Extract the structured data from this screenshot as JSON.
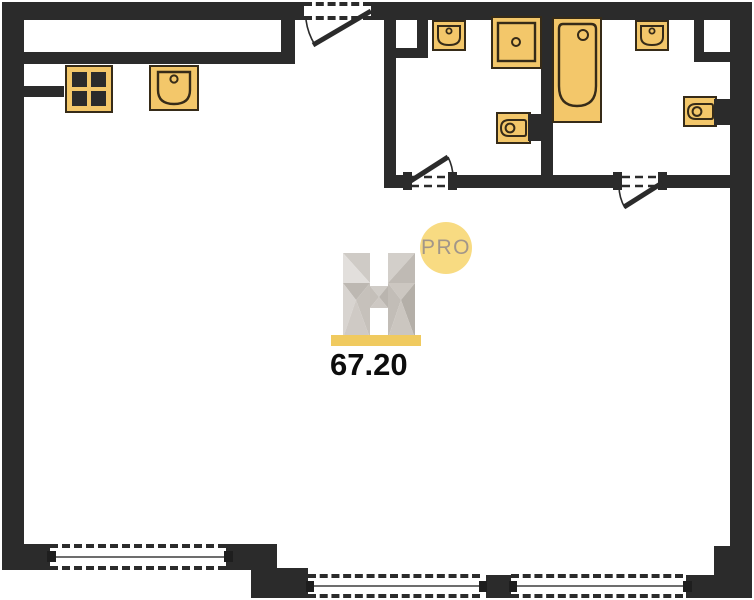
{
  "meta": {
    "kind": "apartment-floor-plan",
    "width_px": 754,
    "height_px": 600
  },
  "branding": {
    "logo_letter": "H",
    "badge": "PRO"
  },
  "area_label": {
    "value": "67.20"
  },
  "colors": {
    "wall": "#2b2b2b",
    "fixture_fill": "#F3C76A",
    "fixture_stroke": "#362B18",
    "logo_bar_yellow": "#F0CA5F",
    "badge_fill": "#F8DB82",
    "badge_text": "#A29689",
    "window_center_line": "#6d6d6d",
    "area_text": "#0d0d0d",
    "logo_gray_light": "#E2DFDC",
    "logo_gray_dark": "#B4AFA8"
  },
  "icons": {
    "fixtures": [
      "stove-icon",
      "kitchen-sink-icon",
      "bathroom-sink-icon",
      "shower-tray-icon",
      "toilet-icon",
      "bathtub-icon",
      "toilet-icon",
      "bathroom-sink-icon"
    ],
    "openings": [
      "entrance-door-swing-icon",
      "bathroom1-door-swing-icon",
      "bathroom2-door-swing-icon"
    ],
    "windows_count": 3
  }
}
